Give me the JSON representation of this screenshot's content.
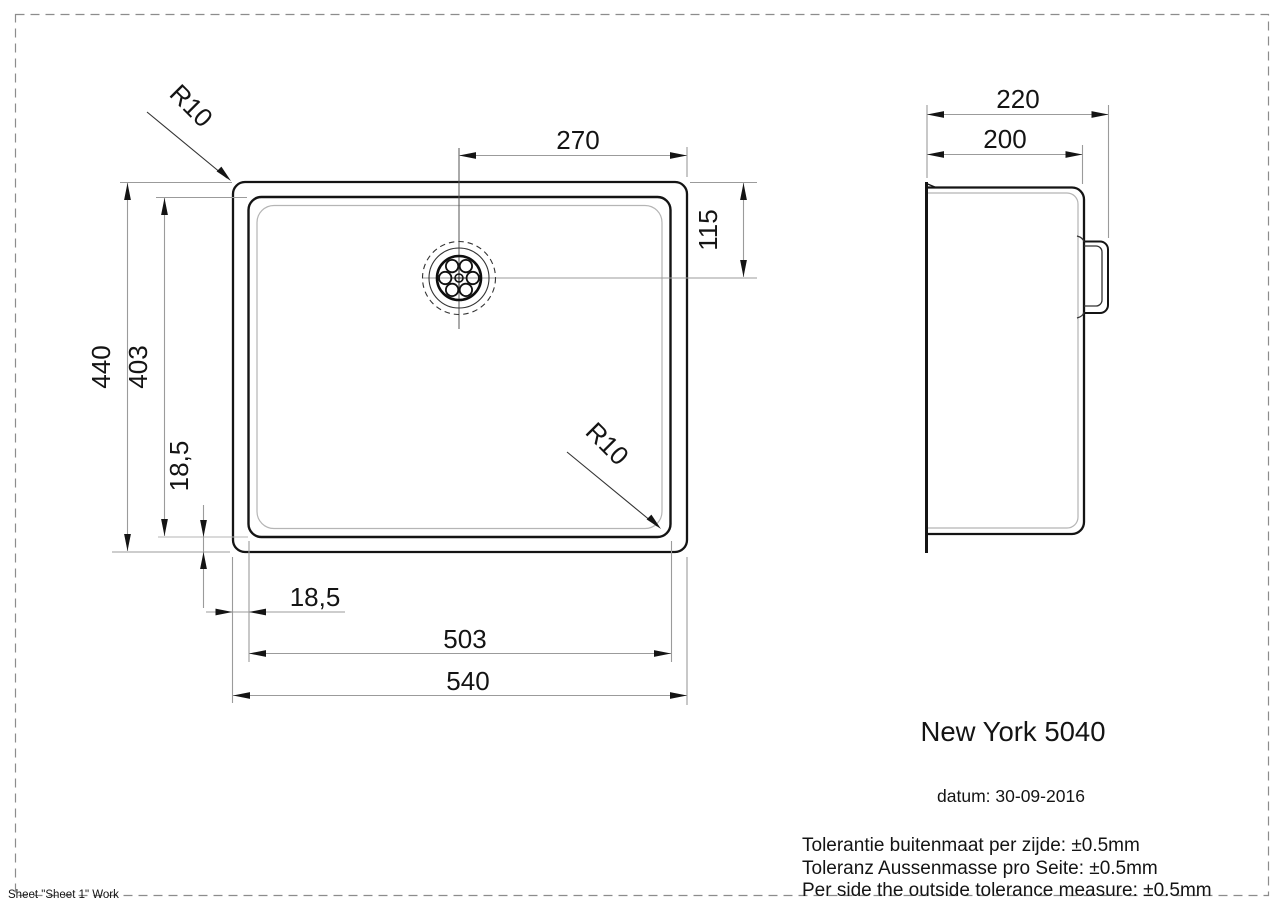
{
  "page": {
    "sheet_label": "Sheet \"Sheet 1\" Work"
  },
  "title_block": {
    "model": "New York 5040",
    "date": "datum: 30-09-2016",
    "tolerances": [
      "Tolerantie buitenmaat per zijde: ±0.5mm",
      "Toleranz Aussenmasse pro Seite: ±0.5mm",
      "Per side the outside tolerance measure: ±0.5mm"
    ]
  },
  "top_view": {
    "dims": {
      "width_outer": "540",
      "width_inner": "503",
      "height_outer": "440",
      "height_inner": "403",
      "drain_from_right": "270",
      "drain_from_top": "115",
      "inset_vertical": "18,5",
      "inset_horizontal": "18,5",
      "radius_top_left": "R10",
      "radius_bottom_right": "R10"
    }
  },
  "side_view": {
    "dims": {
      "depth_outer": "220",
      "depth_inner": "200"
    }
  }
}
